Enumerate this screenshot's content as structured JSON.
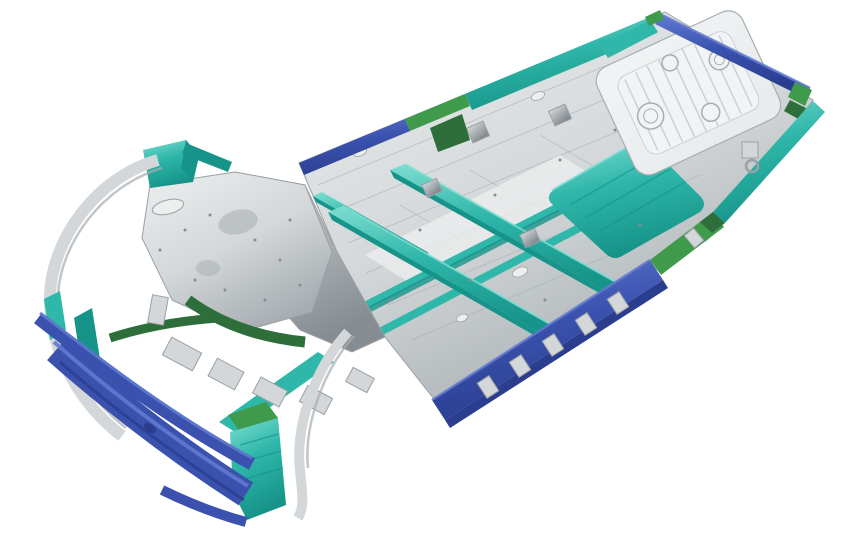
{
  "scene": {
    "type": "3d-render",
    "description": "Isometric rendering of a vehicle body-in-white underbody platform on a white background, front end at lower-left, rear floor at upper-right, with structural parts color-coded blue, teal, green and silver",
    "background": "#ffffff"
  },
  "palette": {
    "white": "#ffffff",
    "blue": "#3a52ae",
    "blue_light": "#6079d0",
    "blue_dark": "#2a3d8f",
    "teal": "#2fb7aa",
    "teal_light": "#7fded2",
    "teal_dark": "#17948a",
    "green": "#3f9b4b",
    "green_dark": "#2d6e3a",
    "silver": "#d3d7d9",
    "silver_light": "#edefef",
    "silver_dark": "#a7adb1",
    "silver_deep": "#868d92",
    "outline": "#9aa0a4",
    "pan_fill": "#e9eced",
    "pan_plateau": "#f1f3f4",
    "rib_line": "#ccd1d3"
  },
  "parts": [
    {
      "id": "main-floor-pan",
      "color": "silver"
    },
    {
      "id": "rear-floor-pan",
      "color": "silver_light"
    },
    {
      "id": "rear-seat-crossmember",
      "color": "teal"
    },
    {
      "id": "floor-crossmembers",
      "color": "teal"
    },
    {
      "id": "tunnel-rails",
      "color": "teal"
    },
    {
      "id": "left-sill-blue-section",
      "color": "blue"
    },
    {
      "id": "left-sill-green-section",
      "color": "green"
    },
    {
      "id": "left-rear-rail",
      "color": "teal"
    },
    {
      "id": "right-rocker-blue-section",
      "color": "blue"
    },
    {
      "id": "right-rocker-green-section",
      "color": "green"
    },
    {
      "id": "right-rear-rail",
      "color": "teal"
    },
    {
      "id": "rear-bumper-rail",
      "color": "blue"
    },
    {
      "id": "rear-corner-brackets",
      "color": "green"
    },
    {
      "id": "front-bumper-beam-upper",
      "color": "blue"
    },
    {
      "id": "front-bumper-beam-main",
      "color": "blue"
    },
    {
      "id": "front-bumper-lower-tail",
      "color": "blue"
    },
    {
      "id": "front-fender-rail",
      "color": "silver"
    },
    {
      "id": "front-shock-tower",
      "color": "silver"
    },
    {
      "id": "firewall-panel",
      "color": "silver"
    },
    {
      "id": "front-apron-bracket",
      "color": "teal"
    },
    {
      "id": "front-wheel-arch-members",
      "color": "green_dark"
    },
    {
      "id": "front-fender-panel",
      "color": "teal"
    },
    {
      "id": "front-crash-boxes",
      "color": "silver"
    },
    {
      "id": "rocker-brackets",
      "color": "silver"
    },
    {
      "id": "tow-hitch-bracket",
      "color": "silver"
    }
  ]
}
